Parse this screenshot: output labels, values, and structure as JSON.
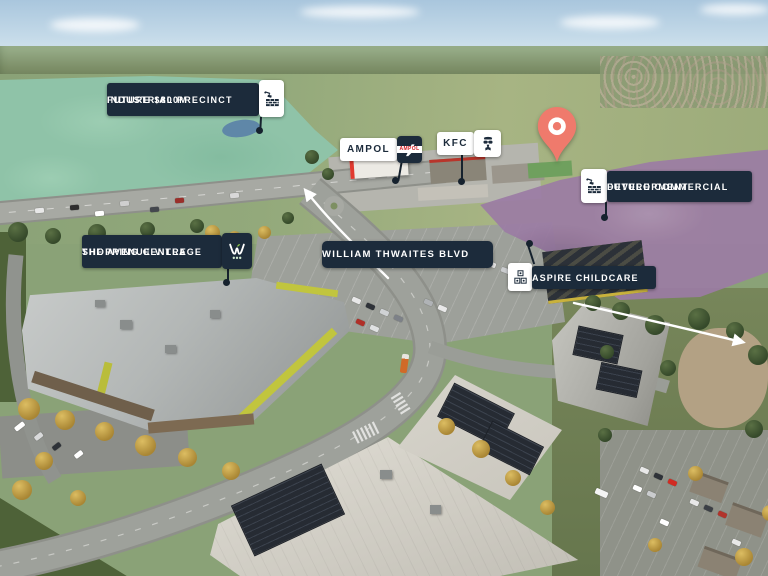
{
  "colors": {
    "label_navy": "#1C2B3B",
    "label_white": "#FFFFFF",
    "pin_coral": "#EF7A6C",
    "industrial_highlight_green": "#8FC3A8",
    "commercial_highlight_purple": "#9C7CA4",
    "ampol_red": "#D31A20",
    "leader_line": "#16222E",
    "arrow_white": "#FFFFFF"
  },
  "labels": {
    "industrial_precinct": {
      "line1": "FUTURE $800M",
      "line2": "INDUSTRIAL PRECINCT",
      "icon": "construction-crane-brick-icon"
    },
    "commercial_development": {
      "line1": "FUTURE COMMERCIAL",
      "line2": "DEVELOPMENT",
      "icon": "construction-crane-brick-icon"
    },
    "shopping_centre": {
      "line1": "THE AVENUE VILLAGE",
      "line2": "SHOPPING CENTRE",
      "icon": "woolworths-logo-icon"
    },
    "boulevard": {
      "text": "WILLIAM THWAITES BLVD"
    },
    "childcare": {
      "text": "ASPIRE CHILDCARE",
      "icon": "toy-blocks-icon"
    },
    "ampol": {
      "text": "AMPOL",
      "icon": "ampol-logo-icon",
      "logo_wordmark": "AMPOL"
    },
    "kfc": {
      "text": "KFC",
      "icon": "kfc-colonel-icon"
    }
  },
  "pin": {
    "icon": "location-pin-icon",
    "color": "#EF7A6C"
  }
}
